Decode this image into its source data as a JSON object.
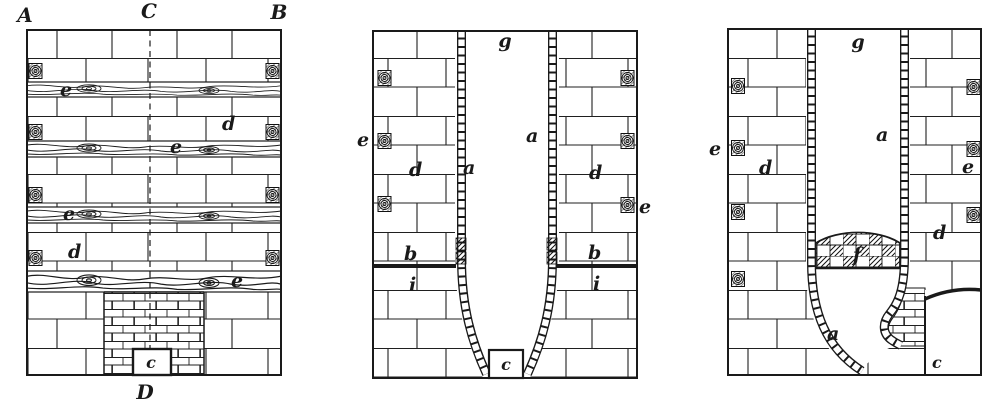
{
  "figure": {
    "paper_color": "#ffffff",
    "ink_color": "#1a1a1a",
    "panels": [
      {
        "id": "left",
        "labels": {
          "top_left": "A",
          "top_center": "C",
          "top_right": "B",
          "bottom_center": "D",
          "beam_1": "e",
          "beam_2": "e",
          "beam_3": "e",
          "beam_4": "e",
          "masonry_upper": "d",
          "masonry_lower": "d",
          "opening": "c"
        }
      },
      {
        "id": "middle",
        "labels": {
          "flue": "g",
          "lining_left": "a",
          "lining_right": "a",
          "beam_end_left": "e",
          "beam_end_right": "e",
          "masonry_left": "d",
          "masonry_right": "d",
          "band_left": "b",
          "band_right": "b",
          "course_left": "i",
          "course_right": "i",
          "opening": "c"
        }
      },
      {
        "id": "right",
        "labels": {
          "flue": "g",
          "lining_upper": "a",
          "lining_lower": "a",
          "beam_end_left": "e",
          "beam_end_right": "e",
          "masonry_left": "d",
          "masonry_right": "d",
          "arch": "f",
          "opening": "c"
        }
      }
    ]
  }
}
